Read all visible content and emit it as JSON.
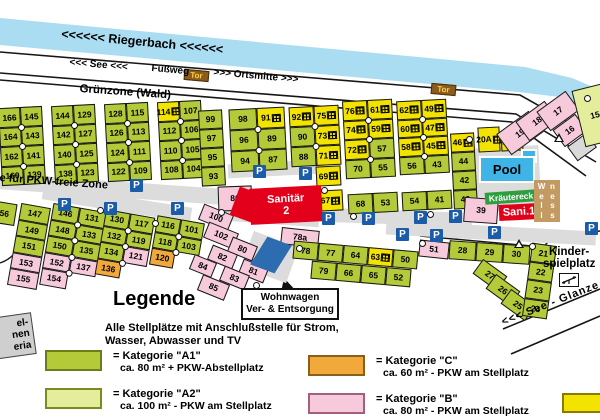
{
  "header": {
    "river": "<<<<<< Riegerbach <<<<<<",
    "see": "<<< See <<<",
    "fussweg": "Fußweg",
    "ortsmitte": ">>> Ortsmitte >>>",
    "tor": "Tor",
    "gruenzone": "Grünzone (Wald)"
  },
  "roads": {
    "pkw_zone": "e für PKW-freie Zone",
    "see_glanze": "<<< See  -  Glanze"
  },
  "facilities": {
    "sanitaer_line1": "Sanitär",
    "sanitaer_line2": "2",
    "sani1": "Sani.1",
    "pool": "Pool",
    "kraeutereck": "Kräutereck",
    "wellness_col1": "Well",
    "wellness_col2": "ness",
    "kinder_line1": "Kinder-",
    "kinder_line2": "spielplatz",
    "wohnwagen_line1": "Wohnwagen",
    "wohnwagen_line2": "Ver- & Entsorgung"
  },
  "sign": {
    "line1": "el-",
    "line2": "nen",
    "line3": "eria"
  },
  "legend": {
    "title": "Legende",
    "intro1": "Alle Stellplätze mit Anschlußstelle für Strom,",
    "intro2": "Wasser, Abwasser und TV",
    "entries": [
      {
        "x": 45,
        "y": 350,
        "color": "#b4ca39",
        "border": "#6d7d1a",
        "line1": "= Kategorie \"A1\"",
        "line2": "ca. 80 m² + PKW-Abstellplatz"
      },
      {
        "x": 45,
        "y": 388,
        "color": "#e4ed9b",
        "border": "#7d8a20",
        "line1": "= Kategorie \"A2\"",
        "line2": "ca. 100 m² - PKW am Stellplatz"
      },
      {
        "x": 308,
        "y": 355,
        "color": "#f2a93b",
        "border": "#8a5f1a",
        "line1": "= Kategorie \"C\"",
        "line2": "ca. 60 m² - PKW am Stellplatz"
      },
      {
        "x": 308,
        "y": 393,
        "color": "#f6cadb",
        "border": "#a2607e",
        "line1": "= Kategorie \"B\"",
        "line2": "ca. 80 m² - PKW am Stellplatz"
      }
    ],
    "partial_swatch": {
      "color": "#f2e300",
      "border": "#8a7a00"
    }
  },
  "map": {
    "parking_label": "P",
    "blocks": [
      {
        "x": -26,
        "y": 112,
        "rot": -3,
        "cw": 24,
        "ch": 19,
        "rows": [
          [
            "|a"
          ],
          [
            "|a"
          ],
          [
            "|a"
          ],
          [
            "|a"
          ]
        ]
      },
      {
        "x": 0,
        "y": 107,
        "rot": -3,
        "cw": 22,
        "ch": 19.5,
        "rows": [
          [
            "166",
            "145"
          ],
          [
            "164",
            "143"
          ],
          [
            "162",
            "141"
          ],
          [
            "160",
            "139"
          ]
        ]
      },
      {
        "x": 53,
        "y": 105,
        "rot": -3,
        "cw": 22,
        "ch": 19.5,
        "rows": [
          [
            "144",
            "129"
          ],
          [
            "142",
            "127"
          ],
          [
            "140",
            "125"
          ],
          [
            "138",
            "123"
          ]
        ]
      },
      {
        "x": 106,
        "y": 103,
        "rot": -3,
        "cw": 22,
        "ch": 19.5,
        "rows": [
          [
            "128",
            "115"
          ],
          [
            "126",
            "113"
          ],
          [
            "124",
            "111"
          ],
          [
            "122",
            "109"
          ]
        ]
      },
      {
        "x": 159,
        "y": 101,
        "rot": -3,
        "cw": 22,
        "ch": 19.5,
        "rows": [
          [
            "114|y",
            "107"
          ],
          [
            "112",
            "106"
          ],
          [
            "110",
            "105"
          ],
          [
            "108",
            "104"
          ]
        ]
      },
      {
        "x": 200,
        "y": 110,
        "rot": -3,
        "cw": 24,
        "ch": 19,
        "rows": [
          [
            "99"
          ],
          [
            "97"
          ],
          [
            "95"
          ],
          [
            "93"
          ]
        ]
      },
      {
        "x": 230,
        "y": 108,
        "rot": -3,
        "cw": 28,
        "ch": 21,
        "rows": [
          [
            "98",
            "91|y"
          ],
          [
            "96",
            "89"
          ],
          [
            "94",
            "87"
          ]
        ]
      },
      {
        "x": 290,
        "y": 106,
        "rot": -3,
        "cw": 25,
        "ch": 20,
        "rows": [
          [
            "92|y",
            "75|y"
          ],
          [
            "90",
            "73|y"
          ],
          [
            "88",
            "71|y"
          ]
        ]
      },
      {
        "x": 316,
        "y": 166,
        "rot": -3,
        "cw": 25,
        "ch": 20,
        "rows": [
          [
            "69|y"
          ]
        ]
      },
      {
        "x": 318,
        "y": 190,
        "rot": -3,
        "cw": 25,
        "ch": 21,
        "rows": [
          [
            "67|y"
          ]
        ]
      },
      {
        "x": 344,
        "y": 100,
        "rot": -3,
        "cw": 25,
        "ch": 19.5,
        "rows": [
          [
            "76|y",
            "61|y"
          ],
          [
            "74|y",
            "59|y"
          ],
          [
            "72|y",
            "57"
          ],
          [
            "70",
            "55"
          ]
        ]
      },
      {
        "x": 348,
        "y": 193,
        "rot": -3,
        "cw": 25,
        "ch": 20,
        "rows": [
          [
            "68",
            "53"
          ]
        ]
      },
      {
        "x": 398,
        "y": 100,
        "rot": -3,
        "cw": 25,
        "ch": 18.5,
        "rows": [
          [
            "62|y",
            "49|y"
          ],
          [
            "60|y",
            "47|y"
          ],
          [
            "58|y",
            "45|y"
          ],
          [
            "56",
            "43"
          ]
        ]
      },
      {
        "x": 402,
        "y": 191,
        "rot": -3,
        "cw": 25,
        "ch": 19,
        "rows": [
          [
            "54",
            "41"
          ]
        ]
      },
      {
        "x": 452,
        "y": 133,
        "rot": -3,
        "cw": 24,
        "ch": 19,
        "rows": [
          [
            "46|y"
          ],
          [
            "44"
          ],
          [
            "42"
          ],
          [
            "40"
          ]
        ]
      },
      {
        "x": 478,
        "y": 127,
        "rot": -3,
        "cw": 22,
        "ch": 25,
        "rows": [
          [
            "20A|y"
          ]
        ]
      },
      {
        "x": 501,
        "y": 132,
        "rot": -3,
        "cw": 22,
        "ch": 19,
        "rows": [
          [
            "20|y"
          ]
        ]
      },
      {
        "x": 500,
        "y": 120,
        "rot": -36,
        "cw": 40,
        "ch": 26,
        "rows": [
          [
            "19|b"
          ]
        ]
      },
      {
        "x": 519,
        "y": 109,
        "rot": -36,
        "cw": 36,
        "ch": 24,
        "rows": [
          [
            "18|b"
          ]
        ]
      },
      {
        "x": 540,
        "y": 99,
        "rot": -36,
        "cw": 36,
        "ch": 24,
        "rows": [
          [
            "17|b"
          ]
        ]
      },
      {
        "x": 556,
        "y": 120,
        "rot": -36,
        "cw": 28,
        "ch": 21,
        "rows": [
          [
            "16|b"
          ]
        ]
      },
      {
        "x": 570,
        "y": 138,
        "rot": -36,
        "cw": 24,
        "ch": 18,
        "rows": [
          [
            "|g"
          ]
        ]
      },
      {
        "x": 578,
        "y": 86,
        "rot": -14,
        "cw": 34,
        "ch": 58,
        "rows": [
          [
            "15|a2"
          ]
        ]
      },
      {
        "x": -12,
        "y": 202,
        "rot": 9,
        "cw": 28,
        "ch": 22,
        "rows": [
          [
            "156"
          ]
        ]
      },
      {
        "x": 14,
        "y": 205,
        "rot": 10,
        "cw": 30,
        "ch": 16.5,
        "rows": [
          [
            "147"
          ],
          [
            "149"
          ],
          [
            "151"
          ],
          [
            "153|b"
          ],
          [
            "155|b"
          ]
        ]
      },
      {
        "x": 46,
        "y": 207,
        "rot": 10,
        "cw": 27,
        "ch": 16.5,
        "rows": [
          [
            "146",
            "131"
          ],
          [
            "148",
            "133"
          ],
          [
            "150",
            "135"
          ],
          [
            "152|b",
            "137|b"
          ],
          [
            "154|b",
            null
          ]
        ]
      },
      {
        "x": 100,
        "y": 213,
        "rot": 10,
        "cw": 25,
        "ch": 16.5,
        "rows": [
          [
            "130",
            "117"
          ],
          [
            "132",
            "119"
          ],
          [
            "134",
            "121|b"
          ],
          [
            "136|c",
            null
          ]
        ]
      },
      {
        "x": 153,
        "y": 219,
        "rot": 10,
        "cw": 24,
        "ch": 16.5,
        "rows": [
          [
            "116",
            "101"
          ],
          [
            "118",
            "103"
          ],
          [
            "120|c",
            null
          ]
        ]
      },
      {
        "x": 200,
        "y": 209,
        "rot": 22,
        "cw": 32,
        "ch": 17,
        "rows": [
          [
            "100|b"
          ]
        ]
      },
      {
        "x": 205,
        "y": 227,
        "rot": 22,
        "cw": 32,
        "ch": 17,
        "rows": [
          [
            "102|b"
          ]
        ]
      },
      {
        "x": 229,
        "y": 241,
        "rot": 22,
        "cw": 27,
        "ch": 16,
        "rows": [
          [
            "80|b"
          ]
        ]
      },
      {
        "x": 209,
        "y": 249,
        "rot": 22,
        "cw": 27,
        "ch": 16,
        "rows": [
          [
            "82|b"
          ]
        ]
      },
      {
        "x": 191,
        "y": 258,
        "rot": 22,
        "cw": 24,
        "ch": 16,
        "rows": [
          [
            "84|b"
          ]
        ]
      },
      {
        "x": 240,
        "y": 263,
        "rot": 22,
        "cw": 27,
        "ch": 16,
        "rows": [
          [
            "81|b"
          ]
        ]
      },
      {
        "x": 221,
        "y": 270,
        "rot": 22,
        "cw": 27,
        "ch": 16,
        "rows": [
          [
            "83|b"
          ]
        ]
      },
      {
        "x": 199,
        "y": 279,
        "rot": 22,
        "cw": 29,
        "ch": 17,
        "rows": [
          [
            "85|b"
          ]
        ]
      },
      {
        "x": 218,
        "y": 186,
        "rot": -2,
        "cw": 34,
        "ch": 25,
        "rows": [
          [
            "86|b"
          ]
        ]
      },
      {
        "x": 281,
        "y": 229,
        "rot": 6,
        "cw": 38,
        "ch": 17,
        "rows": [
          [
            "78a|b"
          ]
        ]
      },
      {
        "x": 464,
        "y": 198,
        "rot": 4,
        "cw": 34,
        "ch": 25,
        "rows": [
          [
            "39|b"
          ]
        ]
      },
      {
        "x": 419,
        "y": 241,
        "rot": 6,
        "cw": 30,
        "ch": 17,
        "rows": [
          [
            "51|b"
          ]
        ]
      },
      {
        "x": 293,
        "y": 246,
        "rot": 5,
        "cw": 25,
        "ch": 18,
        "rows": [
          [
            "78",
            "77",
            "64",
            "63|y",
            "50"
          ]
        ]
      },
      {
        "x": 449,
        "y": 243,
        "rot": 4,
        "cw": 27,
        "ch": 19,
        "rows": [
          [
            "28",
            "29",
            "30"
          ]
        ]
      },
      {
        "x": 311,
        "y": 265,
        "rot": 5,
        "cw": 25,
        "ch": 18,
        "rows": [
          [
            "79",
            "66",
            "65",
            "52"
          ]
        ]
      },
      {
        "x": 475,
        "y": 266,
        "rot": 36,
        "cw": 30,
        "ch": 18,
        "rows": [
          [
            "27"
          ]
        ]
      },
      {
        "x": 488,
        "y": 281,
        "rot": 36,
        "cw": 30,
        "ch": 18,
        "rows": [
          [
            "26"
          ]
        ]
      },
      {
        "x": 503,
        "y": 296,
        "rot": 36,
        "cw": 30,
        "ch": 18,
        "rows": [
          [
            "25"
          ]
        ]
      },
      {
        "x": 527,
        "y": 244,
        "rot": 8,
        "cw": 25,
        "ch": 18.5,
        "rows": [
          [
            "21"
          ],
          [
            "22"
          ],
          [
            "23"
          ],
          [
            "24"
          ]
        ]
      }
    ],
    "parking": [
      [
        130,
        179
      ],
      [
        58,
        198
      ],
      [
        104,
        202
      ],
      [
        171,
        202
      ],
      [
        253,
        165
      ],
      [
        299,
        167
      ],
      [
        322,
        212
      ],
      [
        362,
        212
      ],
      [
        414,
        211
      ],
      [
        449,
        210
      ],
      [
        396,
        228
      ],
      [
        430,
        229
      ],
      [
        488,
        226
      ],
      [
        585,
        222
      ]
    ],
    "dots": [
      [
        584,
        95
      ],
      [
        321,
        187
      ],
      [
        350,
        213
      ],
      [
        427,
        211
      ],
      [
        452,
        211
      ],
      [
        466,
        136
      ],
      [
        218,
        209
      ],
      [
        253,
        282
      ],
      [
        296,
        245
      ],
      [
        419,
        240
      ],
      [
        529,
        243
      ],
      [
        97,
        207
      ],
      [
        152,
        220
      ],
      [
        255,
        170
      ]
    ],
    "triangles": [
      [
        514,
        239
      ],
      [
        554,
        133
      ]
    ],
    "gray": [
      [
        0,
        182,
        250,
        16,
        4
      ],
      [
        42,
        196,
        150,
        15,
        9
      ],
      [
        228,
        162,
        92,
        14,
        -3
      ],
      [
        302,
        210,
        170,
        14,
        2
      ],
      [
        386,
        226,
        210,
        14,
        3
      ],
      [
        468,
        147,
        72,
        64,
        -3
      ],
      [
        224,
        212,
        95,
        12,
        4
      ],
      [
        246,
        238,
        48,
        38,
        20
      ]
    ]
  },
  "colors": {
    "river": "#aadcf2",
    "cat_a1": "#b4ca39",
    "cat_a2": "#e4ed9b",
    "cat_yellow": "#f2e300",
    "cat_b_pink": "#f6cadb",
    "cat_c_orange": "#f2a93b",
    "parking_blue": "#1a5ca8",
    "sanitary_red": "#e2001a",
    "pool_blue": "#3fb4e6",
    "kraeutereck_green": "#2f9e41",
    "wellness_tan": "#c39b62",
    "tor_brown": "#8a5c1e",
    "disposal_blue": "#2e6cb0"
  }
}
